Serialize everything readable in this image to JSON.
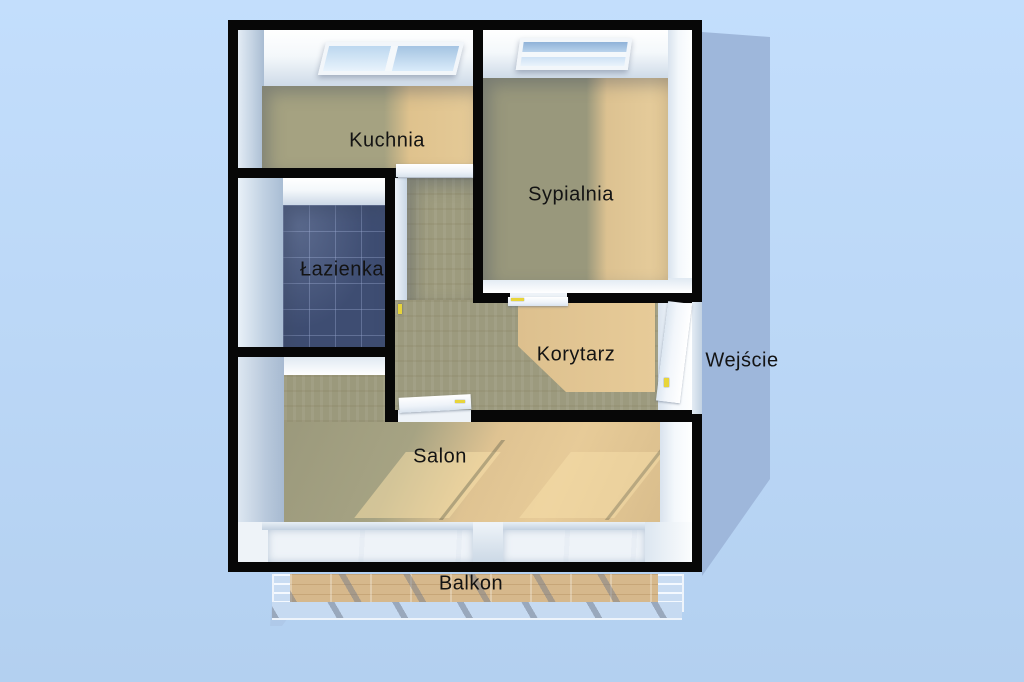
{
  "plan": {
    "type": "apartment-floor-plan-3d-top-view",
    "labels": {
      "kitchen": "Kuchnia",
      "bedroom": "Sypialnia",
      "bathroom": "Łazienka",
      "corridor": "Korytarz",
      "entrance": "Wejście",
      "living_room": "Salon",
      "balcony": "Balkon"
    },
    "palette": {
      "background": "#bcd8f7",
      "cast_shadow": "#9eb7db",
      "wall": "#070707",
      "floor_lit": "#e6ca97",
      "floor_shadow": "#9e9c7e",
      "bathroom_tile": "#3e4d72",
      "skylight_glass": "#a5c4e2",
      "door_leaf": "#f6f9fc",
      "door_handle": "#e8d53a"
    }
  }
}
